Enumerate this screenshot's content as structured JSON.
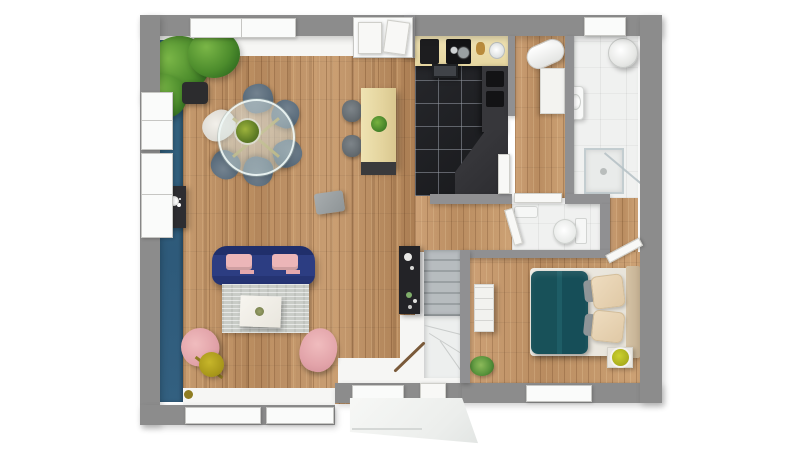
{
  "scene": {
    "description": "Top-down 3D architectural render of a single-storey house floor plan on a white background",
    "render_style": "photoreal dollhouse top view",
    "background_color": "#ffffff",
    "no_visible_text": true
  },
  "palette": {
    "exterior_wall_gray": "#8c8c8c",
    "partition_gray": "#909092",
    "accent_wall_blue": "#336080",
    "wood_floor": "#bd9065",
    "bedroom_wood_floor": "#c49a6d",
    "kitchen_tile_black": "#1f2023",
    "bathroom_tile_white": "#f0f1f0",
    "counter_cream": "#ead9a8",
    "counter_dark": "#37373b",
    "sofa_navy": "#2b3a7e",
    "cushion_pink": "#ecb4b6",
    "armchair_pink": "#eab1b5",
    "rug_gray": "#c9ccc7",
    "bed_blanket_teal": "#1a565f",
    "pillow_beige": "#e9d5ba",
    "headboard_beige": "#cdbb9e",
    "lamp_olive": "#b5a41f",
    "bedside_lamp_chartreuse": "#b8bc25",
    "plant_green": "#4c8c2c",
    "stair_tread_gray": "#aab0b3",
    "porch_white": "#f4f5f3"
  },
  "rooms": [
    {
      "id": "living-dining-room",
      "floor": "wood-planks",
      "features": [
        "blue-accent-wall",
        "dining-set",
        "sofa",
        "rug",
        "coffee-table",
        "armchairs",
        "floor-lamp",
        "console-table",
        "potted-plant",
        "side-table"
      ]
    },
    {
      "id": "kitchen",
      "floor": "black-tile",
      "features": [
        "counter-with-cooktop-and-sink",
        "extractor-hood",
        "dark-counter",
        "peninsula-counter",
        "island-with-stools"
      ]
    },
    {
      "id": "hallway",
      "floor": "wood-planks",
      "features": [
        "water-heater",
        "storage-cabinet"
      ]
    },
    {
      "id": "bathroom",
      "floor": "white-tile",
      "features": [
        "water-heater",
        "washbasin",
        "shower-enclosure"
      ]
    },
    {
      "id": "wc",
      "floor": "white-tile",
      "features": [
        "toilet",
        "hand-basin"
      ]
    },
    {
      "id": "bedroom",
      "floor": "wood-planks",
      "features": [
        "double-bed",
        "nightstand-with-lamp",
        "dresser"
      ]
    },
    {
      "id": "staircase",
      "features": [
        "upper-flight",
        "winder-steps",
        "railing",
        "shelf-unit"
      ]
    },
    {
      "id": "entry",
      "features": [
        "front-door",
        "porch-slab",
        "small-plant"
      ]
    }
  ],
  "furniture": [
    "potted-plant",
    "dining-table-round-glass",
    "dining-chair-slate-x5",
    "dining-chair-white",
    "kitchen-island",
    "bar-stool-x2",
    "console-table",
    "side-table",
    "sofa-navy",
    "pink-cushion-x2",
    "area-rug",
    "coffee-table-white",
    "armchair-pink-x2",
    "floor-lamp-gold",
    "bed-double",
    "blanket-teal",
    "pillow-beige-x2",
    "headboard",
    "nightstand",
    "dresser",
    "shelf-unit-black",
    "entry-plant"
  ],
  "fixtures": [
    "window-top-living",
    "terrace-glass-door",
    "window-bathroom-top",
    "window-left-1",
    "window-left-2",
    "window-bottom-1",
    "window-bottom-2",
    "window-entry",
    "window-bedroom",
    "front-door",
    "kitchen-door",
    "hall-door",
    "wc-door",
    "bedroom-door",
    "cooktop",
    "kitchen-sink",
    "extractor-hood",
    "water-heater-x2",
    "washbasin",
    "shower",
    "toilet",
    "stairs"
  ],
  "counts": {
    "windows": 9,
    "doors": 5,
    "rooms": 8
  }
}
